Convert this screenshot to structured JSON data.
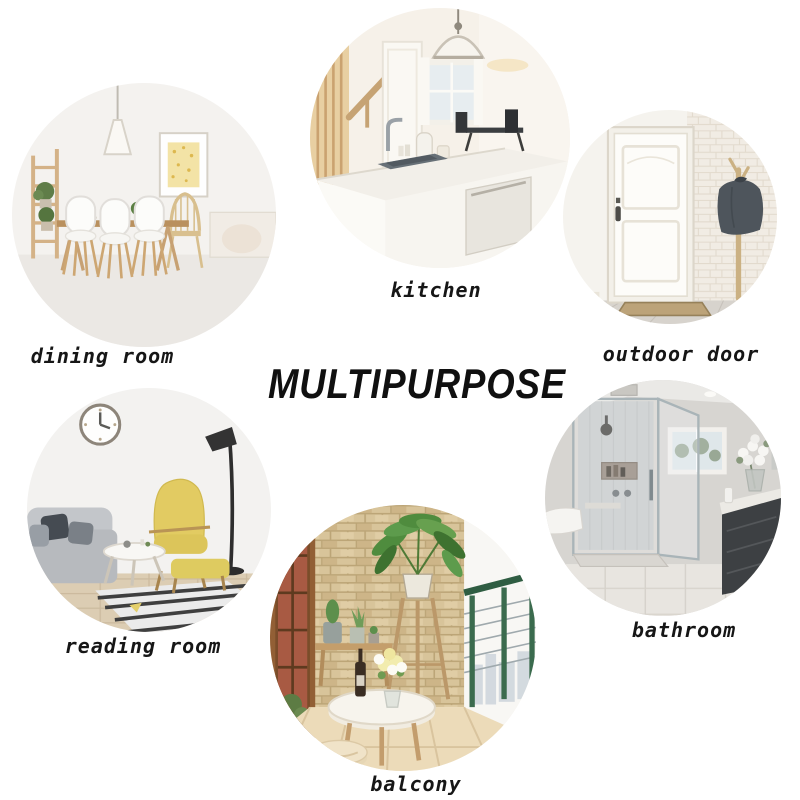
{
  "title": "MULTIPURPOSE",
  "rooms": [
    {
      "id": "dining-room",
      "label": "dining room"
    },
    {
      "id": "kitchen",
      "label": "kitchen"
    },
    {
      "id": "outdoor-door",
      "label": "outdoor door"
    },
    {
      "id": "reading-room",
      "label": "reading room"
    },
    {
      "id": "balcony",
      "label": "balcony"
    },
    {
      "id": "bathroom",
      "label": "bathroom"
    }
  ],
  "colors": {
    "background": "#ffffff",
    "title_text": "#101010",
    "label_text": "#161616"
  }
}
